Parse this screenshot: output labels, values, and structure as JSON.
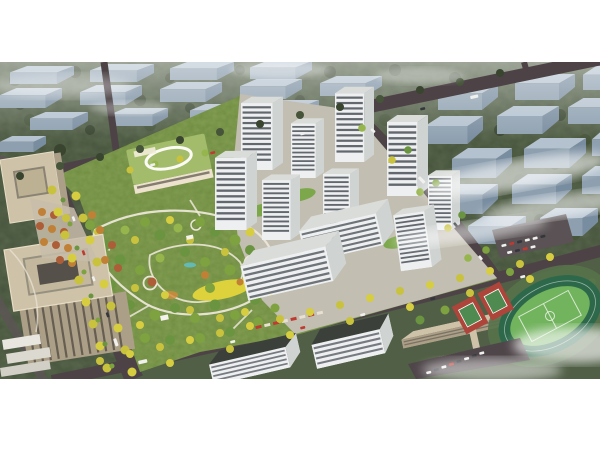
{
  "scene": {
    "type": "aerial-architectural-rendering",
    "summary": "Bird's-eye architectural rendering of a residential development: a cluster of white high-rise apartment towers with green courtyard roofs, a large landscaped central park with winding paths and a yellow meadow, a kindergarten with a green roof, tree-lined avenues with cars, beige office towers at lower left, a school campus with running track and basketball courts at lower right, and rows of hazy grey apartment blocks with drifting clouds in the background. White margins above and below the render.",
    "elements": [
      {
        "name": "white-frame",
        "desc": "white letterbox margins at top and bottom of the image"
      },
      {
        "name": "background-city",
        "desc": "repeating rows of grey-blue apartment slabs among dark green trees, fading into haze"
      },
      {
        "name": "clouds",
        "desc": "soft white mist streaks over the right side and corners"
      },
      {
        "name": "street-grid",
        "desc": "dark asphalt arterial roads crossing diagonally with tiny cars and buses"
      },
      {
        "name": "tower-cluster",
        "desc": "about ten white residential high-rises with dark horizontal window bands"
      },
      {
        "name": "retail-podium",
        "desc": "lower slabs with shops and red awnings along the south street"
      },
      {
        "name": "courtyard-roofs",
        "desc": "green landscaped podium roofs between towers"
      },
      {
        "name": "kindergarten",
        "desc": "cream building with light-green roof and white oval rooftop loop"
      },
      {
        "name": "central-park",
        "desc": "dense green/yellow/orange trees, white looping paths, yellow flower meadow, pavilions, small pond"
      },
      {
        "name": "west-boulevard",
        "desc": "wide tree-lined boulevard running down the left side"
      },
      {
        "name": "office-buildings",
        "desc": "beige office towers with rooftop courtyards at lower left"
      },
      {
        "name": "autumn-plaza",
        "desc": "plaza grid of orange and rust trees beside the boulevard"
      },
      {
        "name": "school-campus",
        "desc": "long beige school slabs with connecting bridge at lower right"
      },
      {
        "name": "sports-ground",
        "desc": "oval running track with green infield and two red basketball courts"
      },
      {
        "name": "parking-lots",
        "desc": "car parks with rows of parked cars at right"
      }
    ]
  },
  "palette": {
    "white_frame": "#ffffff",
    "backdrop_green": "#47533d",
    "slab_top": "#b4c2cf",
    "slab_front": "#8ea0b0",
    "slab_side": "#798da0",
    "mist": "#ffffff",
    "road": "#4d4347",
    "road_light": "#5e5457",
    "pavement": "#c2beb1",
    "plaza": "#c7bda9",
    "park_base": "#6e8c41",
    "path": "#ece6d8",
    "meadow": "#ddd23b",
    "podium_green": "#7ca74a",
    "tower_face": "#edeff0",
    "tower_win": "#454b52",
    "tower_side": "#cfd3d2",
    "tower_roof": "#d9dcd8",
    "kinder_roof": "#a2bc6b",
    "kinder_face": "#ece2cd",
    "office_top": "#cec2a8",
    "office_face": "#ac9f87",
    "office_win": "#5a5348",
    "dark_roof": "#3b403b",
    "track_ring": "#2d684a",
    "field_green": "#72b35e",
    "court_red": "#ae453b",
    "court_green": "#4f8a50",
    "water": "#5ec1c9",
    "tree_green": "#7da23f",
    "tree_yellow": "#c9c23d",
    "tree_orange": "#c08136",
    "tree_rust": "#ad5e38",
    "tree_dark": "#39452f"
  }
}
